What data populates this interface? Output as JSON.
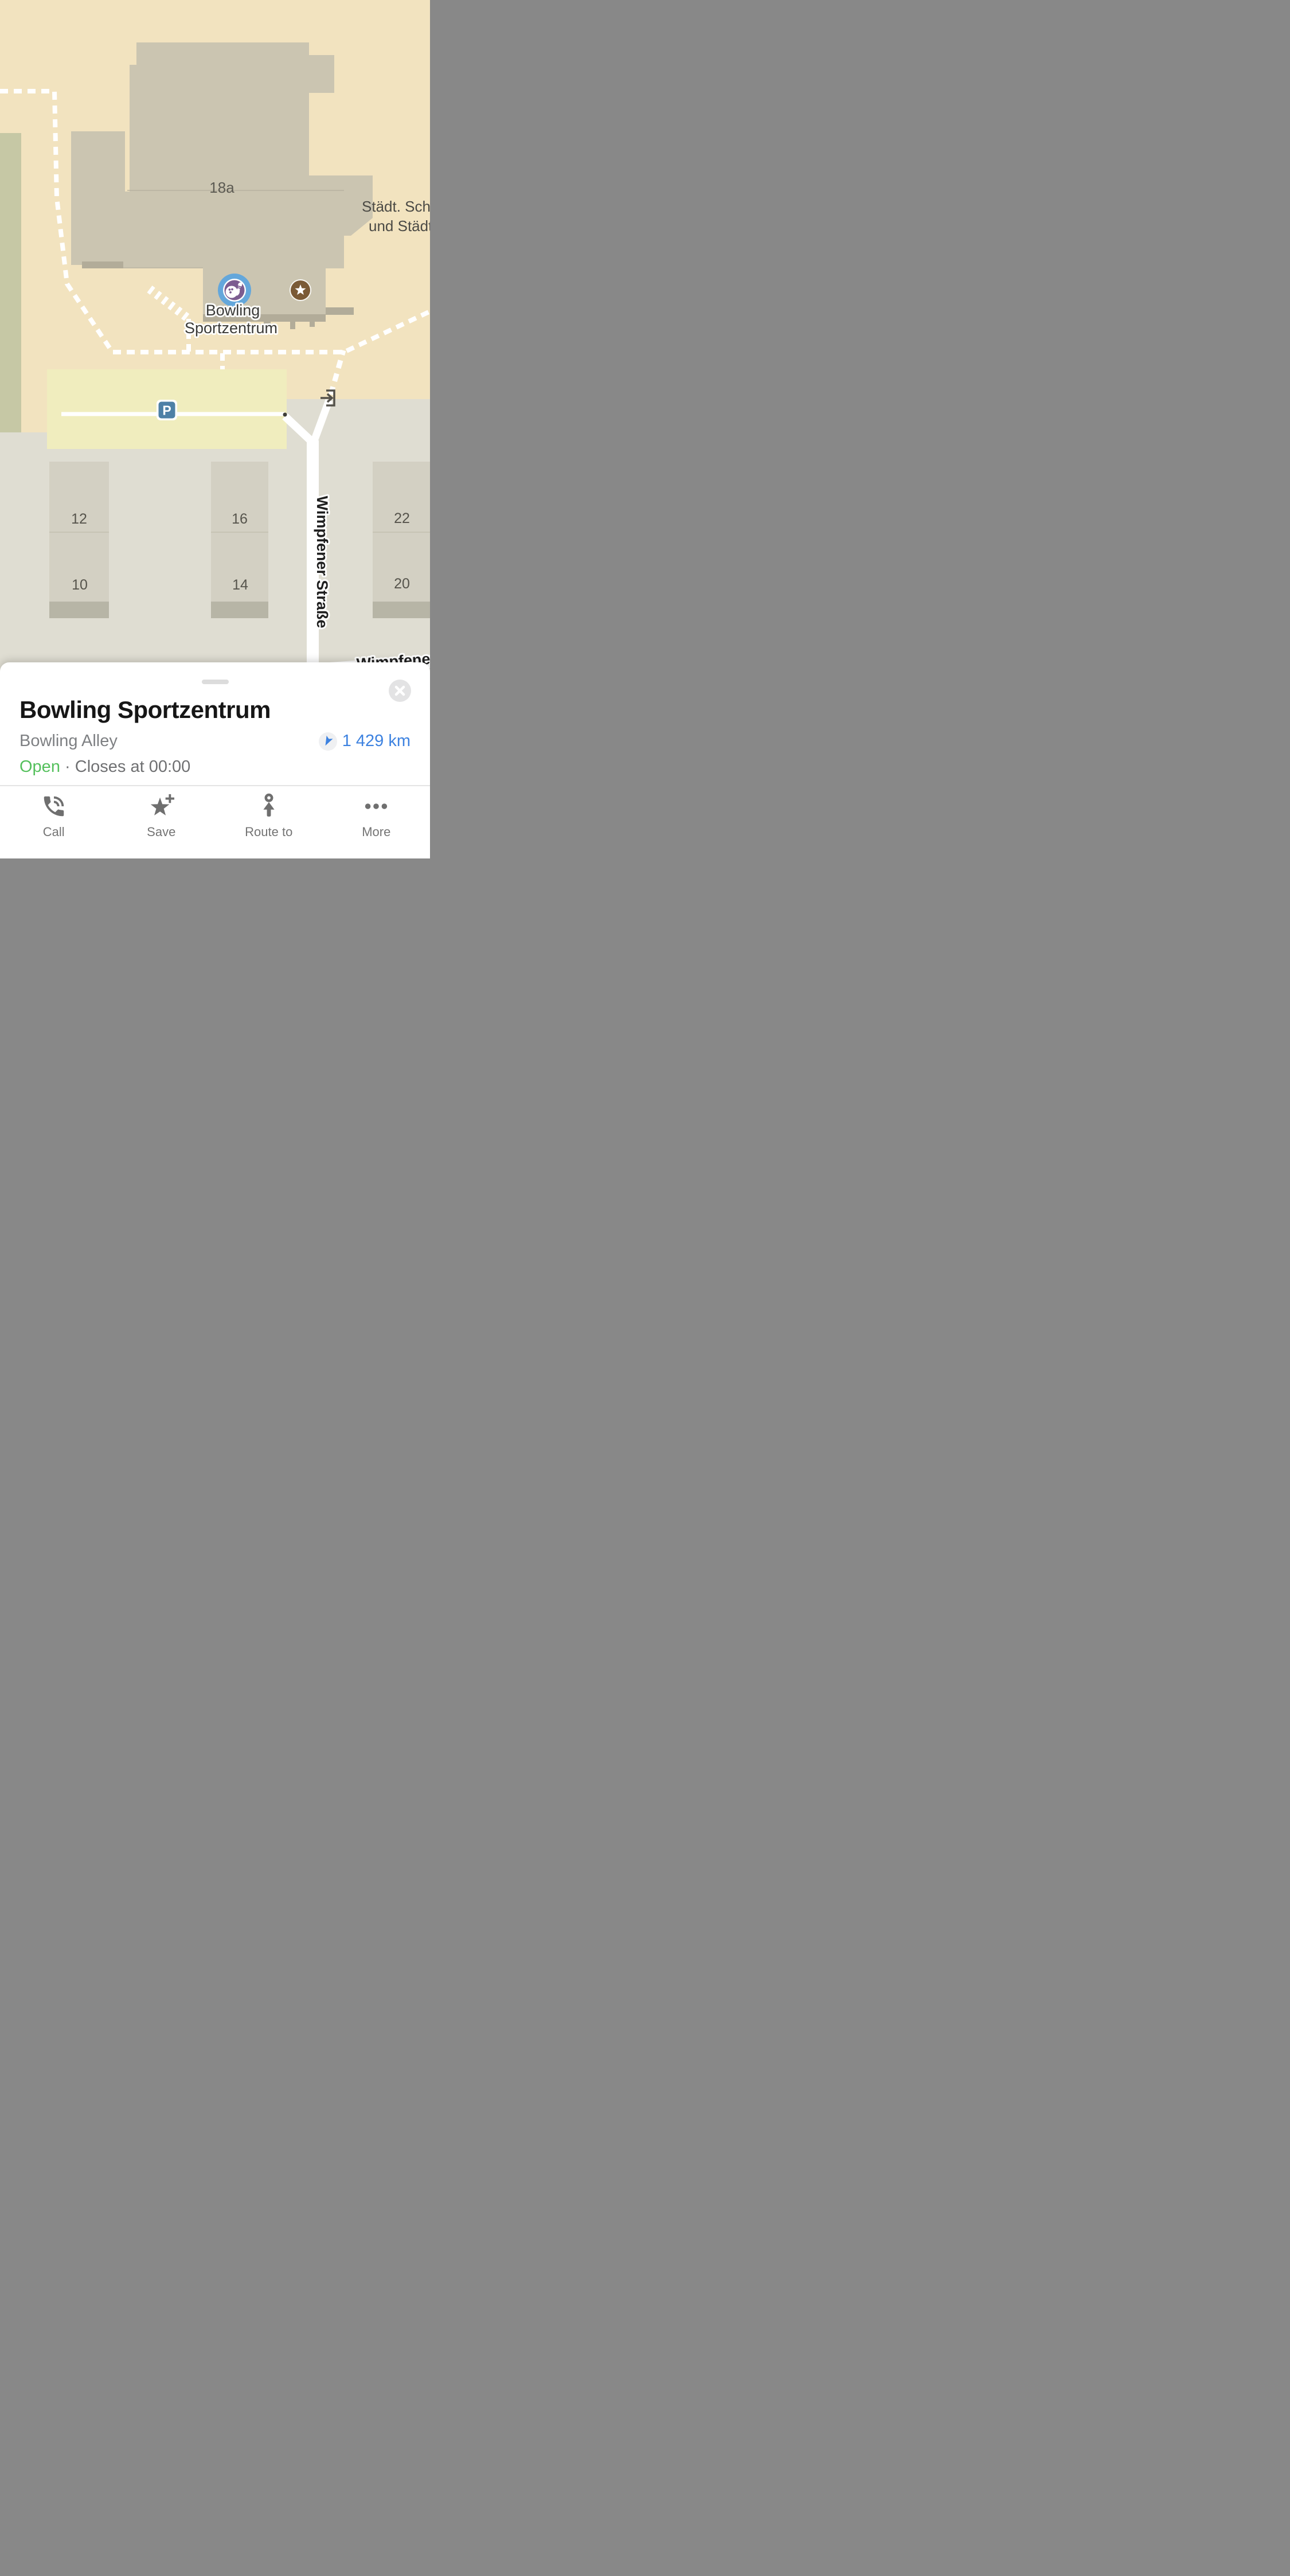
{
  "map": {
    "building_number": "18a",
    "truncated_poi": {
      "line1": "Städt. Schlo",
      "line2": "und Städt."
    },
    "bowling_poi_label": {
      "line1": "Bowling",
      "line2": "Sportzentrum"
    },
    "street_vertical": "Wimpfener Straße",
    "street_bottom": "Wimpfener",
    "parking_letter": "P",
    "blocks": [
      {
        "top": "12",
        "bottom": "10"
      },
      {
        "top": "16",
        "bottom": "14"
      },
      {
        "top": "22",
        "bottom": "20"
      }
    ],
    "colors": {
      "ground_beige": "#F2E3BF",
      "ground_gray": "#DFDDD2",
      "green_area": "#C6C8A5",
      "building": "#CBC5B1",
      "building_shadow": "#B2AC99",
      "house_block": "#D3D0C3",
      "parking_area": "#F0EDBE",
      "road_white": "#FFFFFF",
      "bowling_poi_blue": "#64A7DB",
      "bowling_poi_purple": "#7C5C90",
      "star_poi_brown": "#7A5A36",
      "parking_badge_blue": "#4E80A6"
    }
  },
  "sheet": {
    "title": "Bowling Sportzentrum",
    "category": "Bowling Alley",
    "distance": "1 429 km",
    "status": {
      "open": "Open",
      "separator": "·",
      "closes": "Closes at 00:00"
    },
    "actions": [
      {
        "label": "Call",
        "icon": "phone-icon"
      },
      {
        "label": "Save",
        "icon": "star-plus-icon"
      },
      {
        "label": "Route to",
        "icon": "route-arrow-icon"
      },
      {
        "label": "More",
        "icon": "ellipsis-icon"
      }
    ],
    "accent_blue": "#3d82e0",
    "open_green": "#54c05c"
  }
}
